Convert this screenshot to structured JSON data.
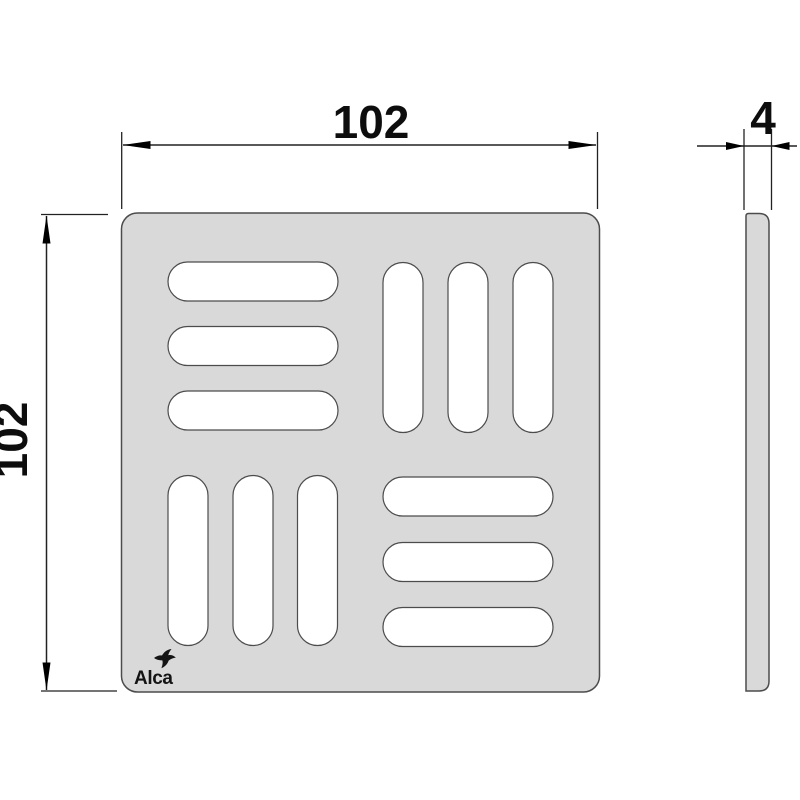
{
  "drawing": {
    "views": {
      "front": {
        "width_dim": "102",
        "height_dim": "102"
      },
      "side": {
        "thickness_dim": "4"
      }
    },
    "logo": {
      "text": "Alca",
      "icon": "swallow-bird-icon"
    },
    "colors": {
      "background": "#ffffff",
      "part_fill": "#d9d9d9",
      "part_stroke": "#4c4c4c",
      "slot_fill": "#ffffff",
      "dimension": "#0d0d0d"
    }
  }
}
